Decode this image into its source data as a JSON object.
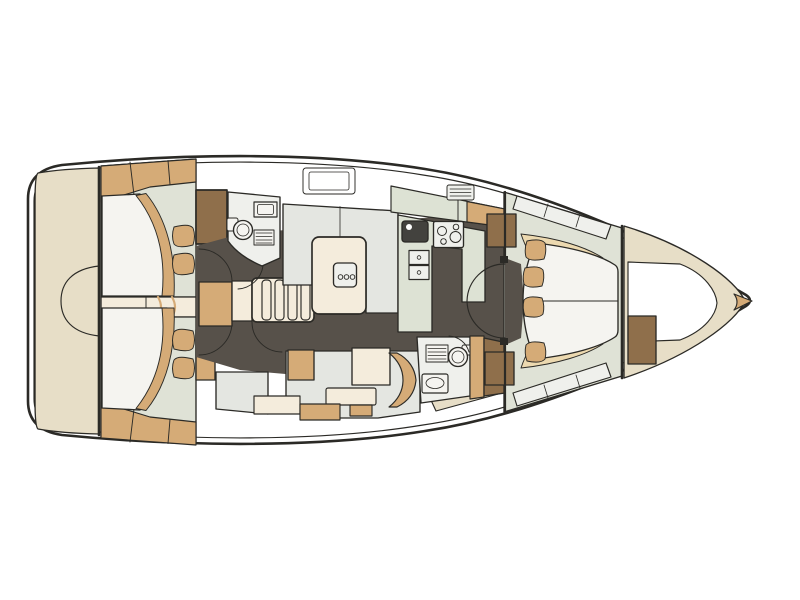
{
  "meta": {
    "drawing_type": "sailing-yacht interior floor plan, top-down view",
    "orientation": "bow-right",
    "background": "#ffffff"
  },
  "colors": {
    "outline": "#2b2a26",
    "hull_white": "#ffffff",
    "deck_cream": "#e7dec7",
    "wood_tan": "#d5ab77",
    "pale_tan": "#ecd9b0",
    "wood_brown": "#8f6f4b",
    "floor_dark": "#57514a",
    "cabin_floor": "#dfe2d6",
    "furniture_gray": "#e4e6e1",
    "room_white": "#eff0ec",
    "mattress_white": "#f5f4f0",
    "counter_green": "#dde2d4",
    "cushion_cream": "#f4ecdc",
    "sink_dark": "#43423e"
  },
  "regions": {
    "stern_platform": "stern platform",
    "aft_cabin_port": "aft cabin (top)",
    "aft_cabin_starboard": "aft cabin (bottom)",
    "aft_head": "aft head / WC",
    "companionway": "companionway stairs",
    "salon": "salon with table",
    "galley": "galley",
    "forward_head": "forward head / WC",
    "settee": "settee / nav seat",
    "owner_cabin": "forward owner cabin",
    "bow_locker": "bow anchor locker"
  }
}
